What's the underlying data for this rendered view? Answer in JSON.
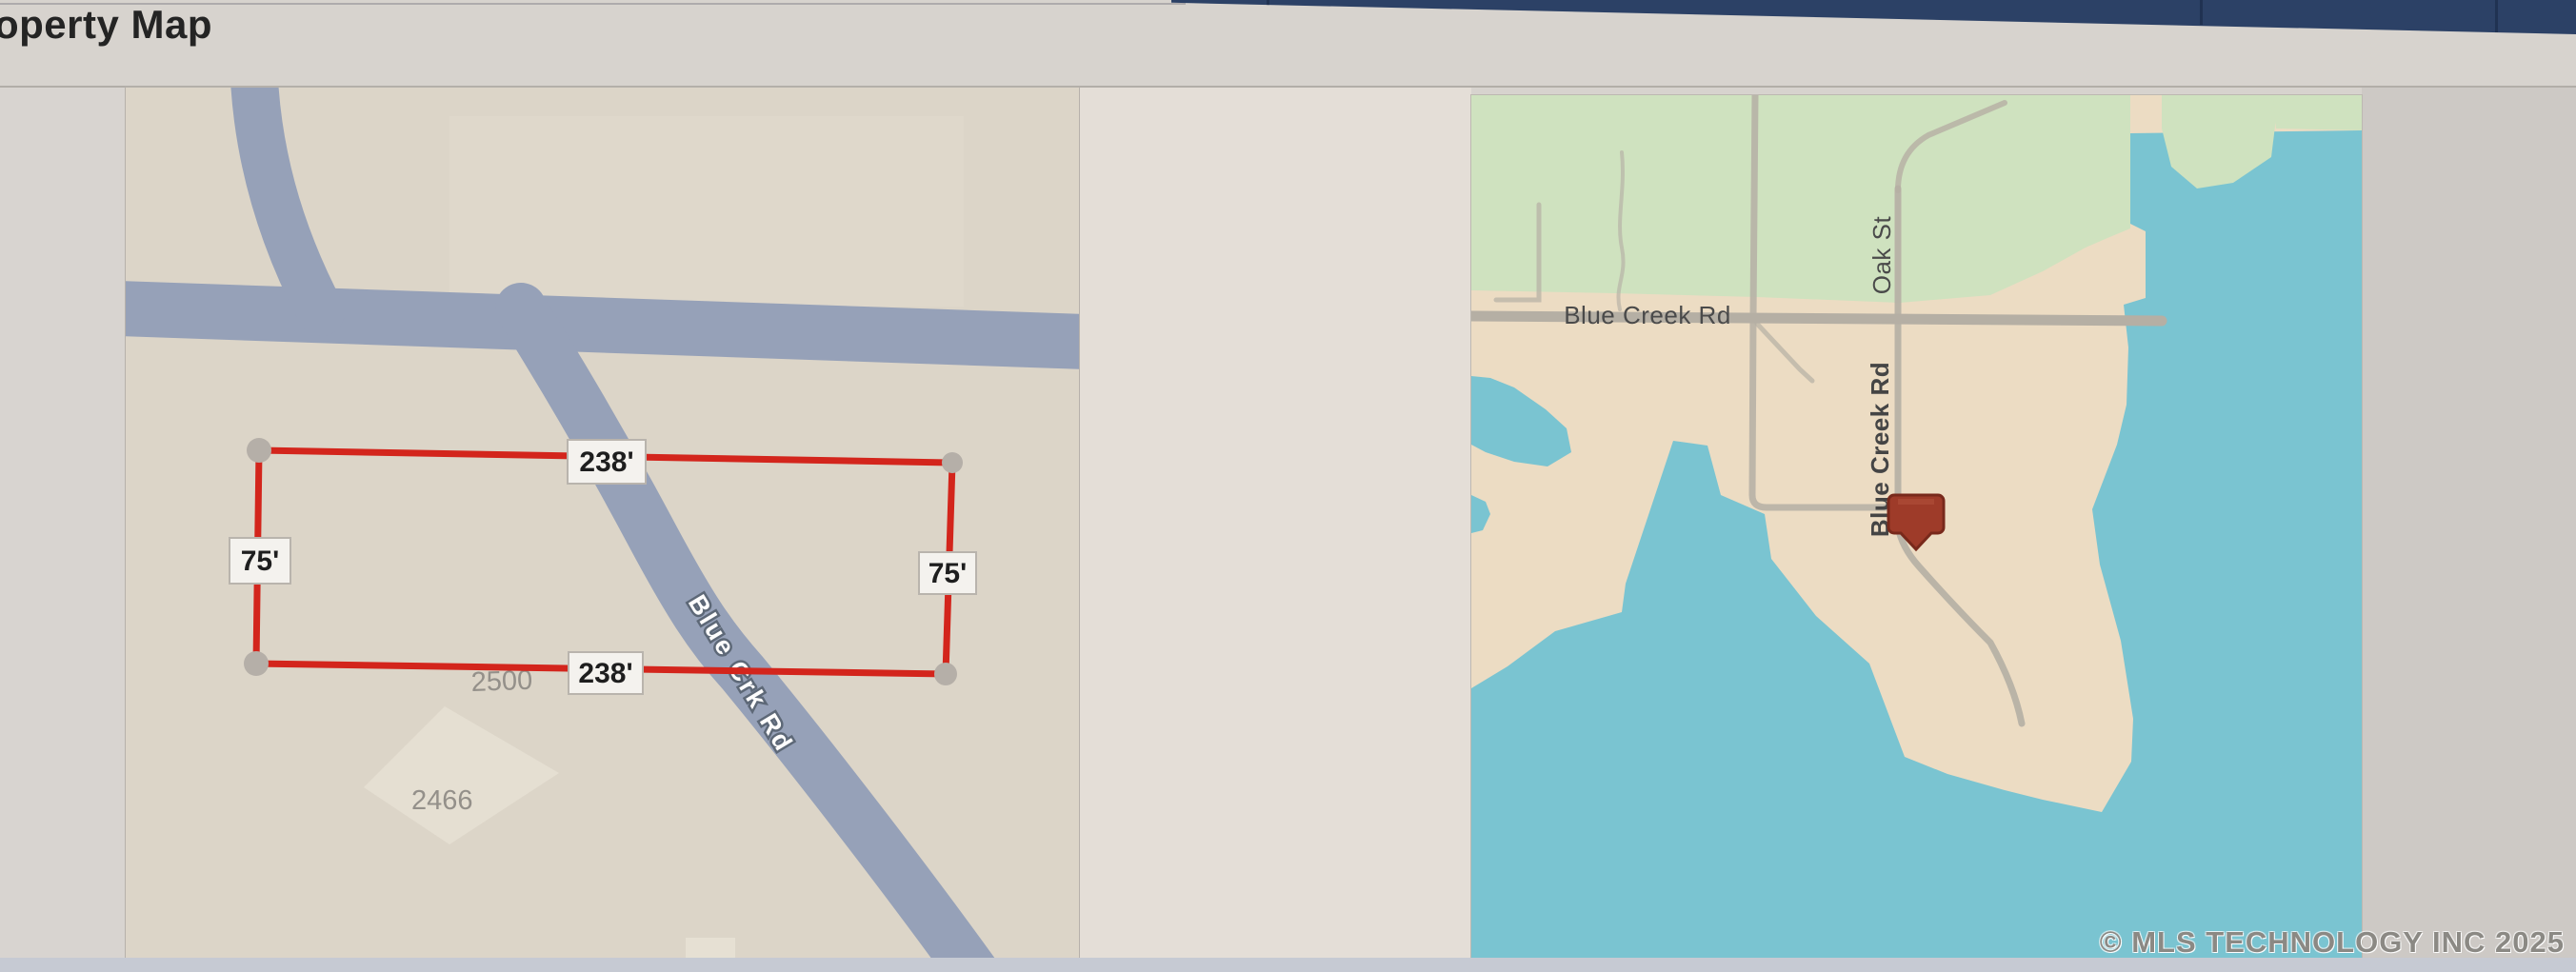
{
  "window": {
    "top_bar_color": "#2c4166"
  },
  "header": {
    "title": "operty Map"
  },
  "plat_map": {
    "street_label": "Blue Crk Rd",
    "dimensions": {
      "top": "238'",
      "bottom": "238'",
      "left": "75'",
      "right": "75'"
    },
    "parcels": {
      "number_left": "2500",
      "number_lower": "2466"
    },
    "colors": {
      "land": "#dcd5c8",
      "road": "#96a1b8",
      "boundary": "#d3251c",
      "label_bg": "#f4f2ee",
      "label_text": "#1e1e1e",
      "parcel_text": "#94908a"
    }
  },
  "location_map": {
    "road_labels": {
      "horizontal": "Blue Creek Rd",
      "vertical_upper": "Oak St",
      "vertical_lower": "Blue Creek Rd"
    },
    "colors": {
      "land": "#ecdcc3",
      "green_area": "#cfe2bf",
      "water": "#7ac4d1",
      "road": "#b5afa4",
      "label_text": "#4a4a4a",
      "marker": "#9e3b29"
    }
  },
  "footer": {
    "copyright": "© MLS TECHNOLOGY INC 2025"
  }
}
